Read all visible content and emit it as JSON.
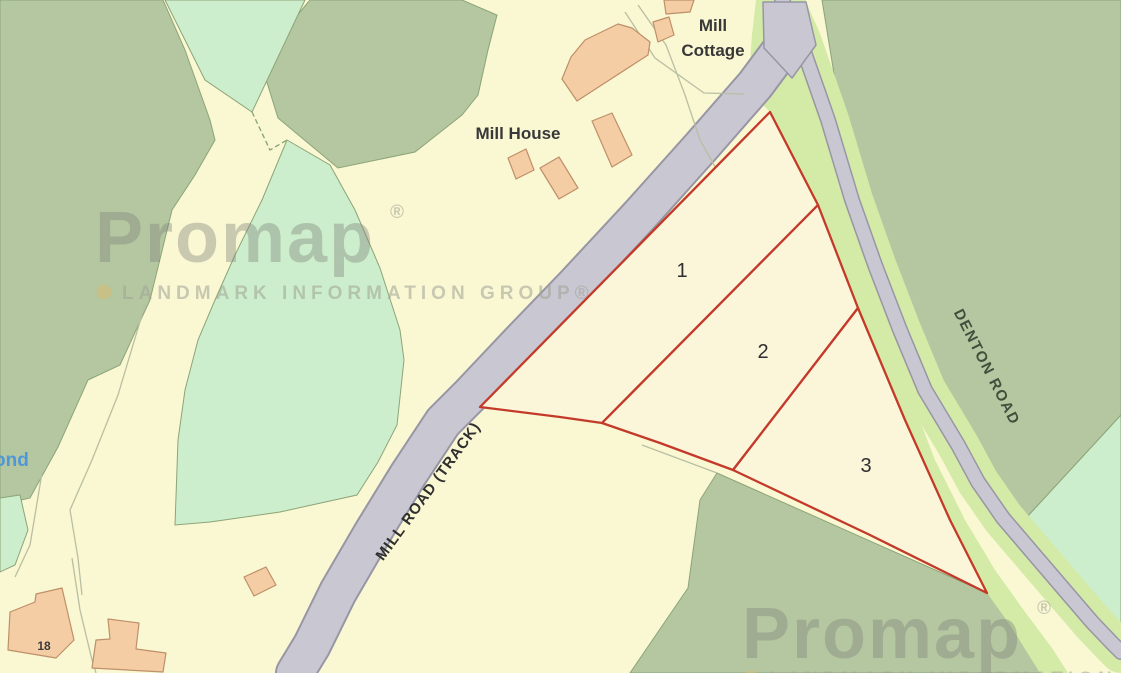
{
  "map_labels": {
    "mill_cottage_line1": "Mill",
    "mill_cottage_line2": "Cottage",
    "mill_house": "Mill House",
    "pond_fragment": "ond",
    "house_number": "18",
    "mill_road": "MILL ROAD (TRACK)",
    "denton_road": "DENTON ROAD"
  },
  "parcels": [
    {
      "number": "1"
    },
    {
      "number": "2"
    },
    {
      "number": "3"
    }
  ],
  "watermark": {
    "brand": "Promap",
    "registered": "®",
    "tagline": "LANDMARK INFORMATION GROUP®",
    "bullet": "dot-icon"
  },
  "colors": {
    "background_field": "#FAF7D3",
    "woodland_sage": "#B4C7A1",
    "rough_grass_mint": "#CDEECC",
    "road_verge": "#D3EBA6",
    "road_surface": "#C9C7D2",
    "road_casing": "#9896A4",
    "building_fill": "#F5CDA5",
    "building_outline": "#BE9068",
    "parcel_boundary_red": "#C43A2A",
    "parcel_fill": "#FBF6DA",
    "pond_text_blue": "#4F98D8",
    "label_dark": "#383838"
  }
}
